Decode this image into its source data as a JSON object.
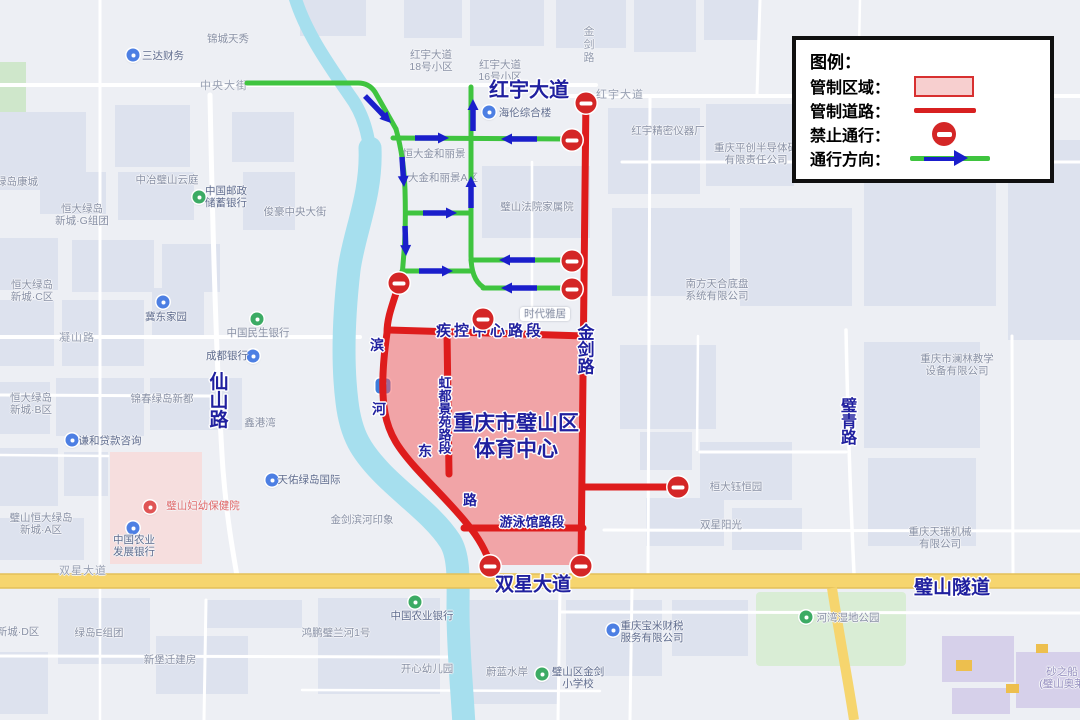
{
  "legend": {
    "title": "图例：",
    "items": [
      {
        "label": "管制区域：",
        "swatch": "area"
      },
      {
        "label": "管制道路：",
        "swatch": "line"
      },
      {
        "label": "禁止通行：",
        "swatch": "noentry"
      },
      {
        "label": "通行方向：",
        "swatch": "arrow"
      }
    ]
  },
  "map": {
    "colors": {
      "control_red": "#de1c1c",
      "zone_fill": "rgba(246,90,90,0.5)",
      "direction_green": "#3fc43f",
      "arrow_blue": "#1a1ecb",
      "water": "#a6dfee",
      "highway_yellow": "#f6d56e"
    },
    "road_name_labels": [
      {
        "text": "红宇大道",
        "x": 529,
        "y": 88,
        "size": 20
      },
      {
        "text": "金剑路",
        "x": 584,
        "y": 349,
        "size": 17,
        "vertical": true
      },
      {
        "text": "重庆市璧山区",
        "x": 516,
        "y": 422,
        "size": 21
      },
      {
        "text": "体育中心",
        "x": 516,
        "y": 448,
        "size": 21
      },
      {
        "text": "疾控中心路段",
        "x": 490,
        "y": 330,
        "size": 15,
        "spacing": 3
      },
      {
        "text": "虹都景苑路段",
        "x": 444,
        "y": 415,
        "size": 13,
        "vertical": true
      },
      {
        "text": "游泳馆路段",
        "x": 532,
        "y": 521,
        "size": 13
      },
      {
        "text": "滨",
        "x": 377,
        "y": 345,
        "size": 14
      },
      {
        "text": "河",
        "x": 379,
        "y": 409,
        "size": 14
      },
      {
        "text": "东",
        "x": 425,
        "y": 451,
        "size": 14
      },
      {
        "text": "路",
        "x": 470,
        "y": 500,
        "size": 14
      },
      {
        "text": "双星大道",
        "x": 533,
        "y": 583,
        "size": 19
      },
      {
        "text": "璧山隧道",
        "x": 952,
        "y": 586,
        "size": 19
      },
      {
        "text": "仙山路",
        "x": 217,
        "y": 400,
        "size": 19,
        "vertical": true
      },
      {
        "text": "璧青路",
        "x": 846,
        "y": 421,
        "size": 16,
        "vertical": true
      }
    ],
    "poi_labels": [
      {
        "lines": [
          "三达财务"
        ],
        "x": 163,
        "y": 56,
        "cls": "dark",
        "icon": {
          "color": "#4d7fe3",
          "x": 133,
          "y": 55
        }
      },
      {
        "lines": [
          "锦城天秀"
        ],
        "x": 228,
        "y": 39
      },
      {
        "lines": [
          "中央大街"
        ],
        "x": 224,
        "y": 86,
        "cls": "roadlbl"
      },
      {
        "lines": [
          "红宇大道",
          "18号小区"
        ],
        "x": 431,
        "y": 61
      },
      {
        "lines": [
          "红宇大道",
          "16号小区"
        ],
        "x": 500,
        "y": 71
      },
      {
        "lines": [
          "红宇大道"
        ],
        "x": 620,
        "y": 95,
        "cls": "roadlbl"
      },
      {
        "lines": [
          "金剑路"
        ],
        "x": 588,
        "y": 45,
        "cls": "roadlbl vert"
      },
      {
        "lines": [
          "海伦综合楼"
        ],
        "x": 525,
        "y": 113,
        "cls": "dark",
        "icon": {
          "color": "#4d7fe3",
          "x": 489,
          "y": 112
        }
      },
      {
        "lines": [
          "红宇精密仪器厂"
        ],
        "x": 668,
        "y": 131
      },
      {
        "lines": [
          "重庆平创半导体研",
          "有限责任公司"
        ],
        "x": 756,
        "y": 154
      },
      {
        "lines": [
          "璧山法院家属院"
        ],
        "x": 537,
        "y": 207
      },
      {
        "lines": [
          "恒大金和丽景"
        ],
        "x": 434,
        "y": 154
      },
      {
        "lines": [
          "大金和丽景A区"
        ],
        "x": 443,
        "y": 178
      },
      {
        "lines": [
          "时代雅居"
        ],
        "x": 545,
        "y": 314,
        "pill": true
      },
      {
        "lines": [
          "南方天合底盘",
          "系统有限公司"
        ],
        "x": 717,
        "y": 290
      },
      {
        "lines": [
          "重庆市澜林教学",
          "设备有限公司"
        ],
        "x": 957,
        "y": 365
      },
      {
        "lines": [
          "桓大钰恒园"
        ],
        "x": 736,
        "y": 487
      },
      {
        "lines": [
          "双星阳光"
        ],
        "x": 721,
        "y": 525
      },
      {
        "lines": [
          "重庆天瑞机械",
          "有限公司"
        ],
        "x": 940,
        "y": 538
      },
      {
        "lines": [
          "凝山路"
        ],
        "x": 77,
        "y": 338,
        "cls": "roadlbl"
      },
      {
        "lines": [
          "冀东家园"
        ],
        "x": 166,
        "y": 317,
        "cls": "dark",
        "icon": {
          "color": "#4d7fe3",
          "x": 163,
          "y": 302
        }
      },
      {
        "lines": [
          "中国民生银行"
        ],
        "x": 258,
        "y": 333,
        "icon": {
          "color": "#3cab64",
          "x": 257,
          "y": 319
        }
      },
      {
        "lines": [
          "成都银行"
        ],
        "x": 227,
        "y": 356,
        "cls": "dark",
        "icon": {
          "color": "#4d7fe3",
          "x": 253,
          "y": 356
        }
      },
      {
        "lines": [
          "恒大绿岛",
          "新城·C区"
        ],
        "x": 32,
        "y": 291
      },
      {
        "lines": [
          "恒大绿岛",
          "新城·B区"
        ],
        "x": 31,
        "y": 404
      },
      {
        "lines": [
          "锦春绿岛新都"
        ],
        "x": 162,
        "y": 399
      },
      {
        "lines": [
          "谦和贷款咨询"
        ],
        "x": 110,
        "y": 441,
        "cls": "dark",
        "icon": {
          "color": "#4d7fe3",
          "x": 72,
          "y": 440
        }
      },
      {
        "lines": [
          "璧山恒大绿岛",
          "新城·A区"
        ],
        "x": 41,
        "y": 524
      },
      {
        "lines": [
          "璧山妇幼保健院"
        ],
        "x": 203,
        "y": 506,
        "cls": "red",
        "icon": {
          "color": "#e05555",
          "x": 150,
          "y": 507
        }
      },
      {
        "lines": [
          "中国农业",
          "发展银行"
        ],
        "x": 134,
        "y": 546,
        "cls": "dark",
        "icon": {
          "color": "#4d7fe3",
          "x": 133,
          "y": 528
        }
      },
      {
        "lines": [
          "金剑滨河印象"
        ],
        "x": 362,
        "y": 520
      },
      {
        "lines": [
          "天佑绿岛国际"
        ],
        "x": 309,
        "y": 480,
        "cls": "dark",
        "icon": {
          "color": "#4d7fe3",
          "x": 272,
          "y": 480
        }
      },
      {
        "lines": [
          "鑫港湾"
        ],
        "x": 260,
        "y": 423
      },
      {
        "lines": [
          "中冶璧山云庭"
        ],
        "x": 167,
        "y": 180
      },
      {
        "lines": [
          "中国邮政",
          "储蓄银行"
        ],
        "x": 226,
        "y": 197,
        "cls": "dark",
        "icon": {
          "color": "#3cab64",
          "x": 199,
          "y": 197
        }
      },
      {
        "lines": [
          "俊豪中央大街"
        ],
        "x": 295,
        "y": 212
      },
      {
        "lines": [
          "恒大绿岛",
          "新城·G组团"
        ],
        "x": 82,
        "y": 215
      },
      {
        "lines": [
          "绿岛康城"
        ],
        "x": 17,
        "y": 182
      },
      {
        "lines": [
          "双星大道"
        ],
        "x": 83,
        "y": 571,
        "cls": "roadlbl"
      },
      {
        "lines": [
          "中国农业银行"
        ],
        "x": 422,
        "y": 616,
        "cls": "dark",
        "icon": {
          "color": "#3cab64",
          "x": 415,
          "y": 602
        }
      },
      {
        "lines": [
          "开心幼儿园"
        ],
        "x": 427,
        "y": 669
      },
      {
        "lines": [
          "蔚蓝水岸"
        ],
        "x": 507,
        "y": 672
      },
      {
        "lines": [
          "璧山区金剑",
          "小学校"
        ],
        "x": 578,
        "y": 678,
        "cls": "dark",
        "icon": {
          "color": "#3cab64",
          "x": 542,
          "y": 674
        }
      },
      {
        "lines": [
          "重庆宝米财税",
          "服务有限公司"
        ],
        "x": 652,
        "y": 632,
        "cls": "dark",
        "icon": {
          "color": "#4d7fe3",
          "x": 613,
          "y": 630
        }
      },
      {
        "lines": [
          "绿岛E组团"
        ],
        "x": 99,
        "y": 633
      },
      {
        "lines": [
          "新堡迁建房"
        ],
        "x": 170,
        "y": 660
      },
      {
        "lines": [
          "新城·D区"
        ],
        "x": 18,
        "y": 632
      },
      {
        "lines": [
          "鸿鹏璧兰河1号"
        ],
        "x": 336,
        "y": 633
      },
      {
        "lines": [
          "河湾湿地公园"
        ],
        "x": 848,
        "y": 618,
        "icon": {
          "color": "#3cab64",
          "x": 806,
          "y": 617
        }
      },
      {
        "lines": [
          "砂之船",
          "(璧山奥莱"
        ],
        "x": 1062,
        "y": 678,
        "cls": "purple"
      },
      {
        "lines": [
          "P"
        ],
        "x": 383,
        "y": 386,
        "cls": "p-icon"
      }
    ],
    "no_entry_signs": [
      [
        586,
        103
      ],
      [
        572,
        140
      ],
      [
        572,
        261
      ],
      [
        572,
        289
      ],
      [
        399,
        283
      ],
      [
        483,
        319
      ],
      [
        678,
        487
      ],
      [
        490,
        566
      ],
      [
        581,
        566
      ]
    ],
    "direction_arrows": [
      {
        "x1": 365,
        "y1": 96,
        "x2": 391,
        "y2": 123
      },
      {
        "x1": 402,
        "y1": 157,
        "x2": 404,
        "y2": 187
      },
      {
        "x1": 405,
        "y1": 226,
        "x2": 406,
        "y2": 256
      },
      {
        "x1": 415,
        "y1": 138,
        "x2": 449,
        "y2": 138
      },
      {
        "x1": 537,
        "y1": 139,
        "x2": 501,
        "y2": 139
      },
      {
        "x1": 473,
        "y1": 131,
        "x2": 473,
        "y2": 99
      },
      {
        "x1": 471,
        "y1": 208,
        "x2": 471,
        "y2": 176
      },
      {
        "x1": 423,
        "y1": 213,
        "x2": 457,
        "y2": 213
      },
      {
        "x1": 535,
        "y1": 260,
        "x2": 499,
        "y2": 260
      },
      {
        "x1": 419,
        "y1": 271,
        "x2": 453,
        "y2": 271
      },
      {
        "x1": 537,
        "y1": 288,
        "x2": 501,
        "y2": 288
      }
    ]
  }
}
